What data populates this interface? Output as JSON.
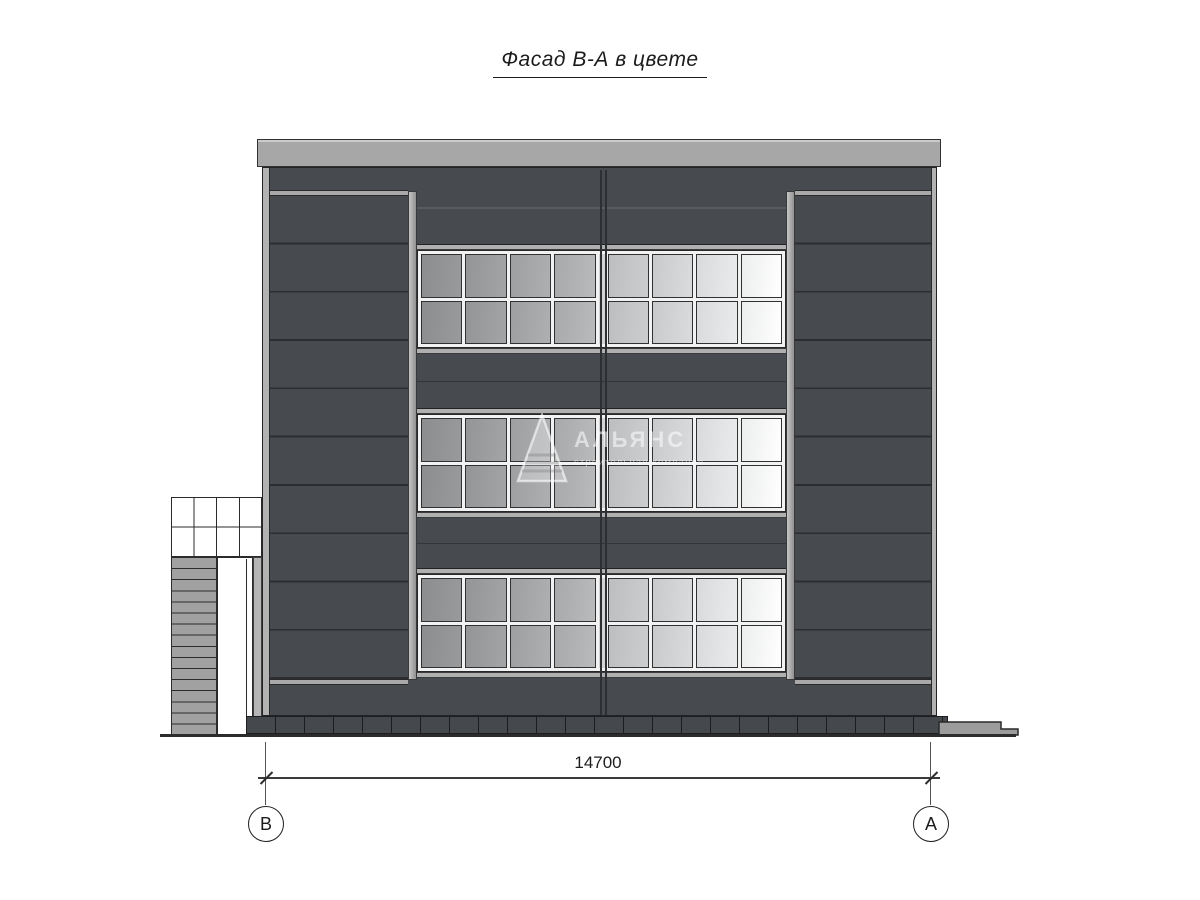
{
  "title": {
    "text": "Фасад В-А в цвете"
  },
  "watermark": {
    "name": "АЛЬЯНС",
    "tagline": "строительная компания"
  },
  "dimension": {
    "value": "14700"
  },
  "axes": {
    "left": "В",
    "right": "А"
  },
  "facade": {
    "colors": {
      "panel_dark": "#474a4f",
      "joint_dark": "#2b2d30",
      "metal_light": "#b2b2b2",
      "roof_cap": "#a7a7a7",
      "plinth": "#45484d",
      "window_frame": "#f2f2f2"
    },
    "window_bands": {
      "count": 3,
      "rows": 2,
      "columns": 8,
      "pane_gradients": [
        [
          "#8c8d8f",
          "#999a9c"
        ],
        [
          "#949597",
          "#a3a4a6"
        ],
        [
          "#9e9fa1",
          "#aeafb1"
        ],
        [
          "#a8a9ab",
          "#b9babc"
        ],
        [
          "#bdbec0",
          "#cccdcf"
        ],
        [
          "#c9cacc",
          "#dadbdd"
        ],
        [
          "#d9dadc",
          "#eaebed"
        ],
        [
          "#eceded",
          "#ffffff"
        ]
      ]
    },
    "entrance": {
      "canopy_cols": 4,
      "canopy_rows": 2,
      "stair_steps": 16
    }
  }
}
